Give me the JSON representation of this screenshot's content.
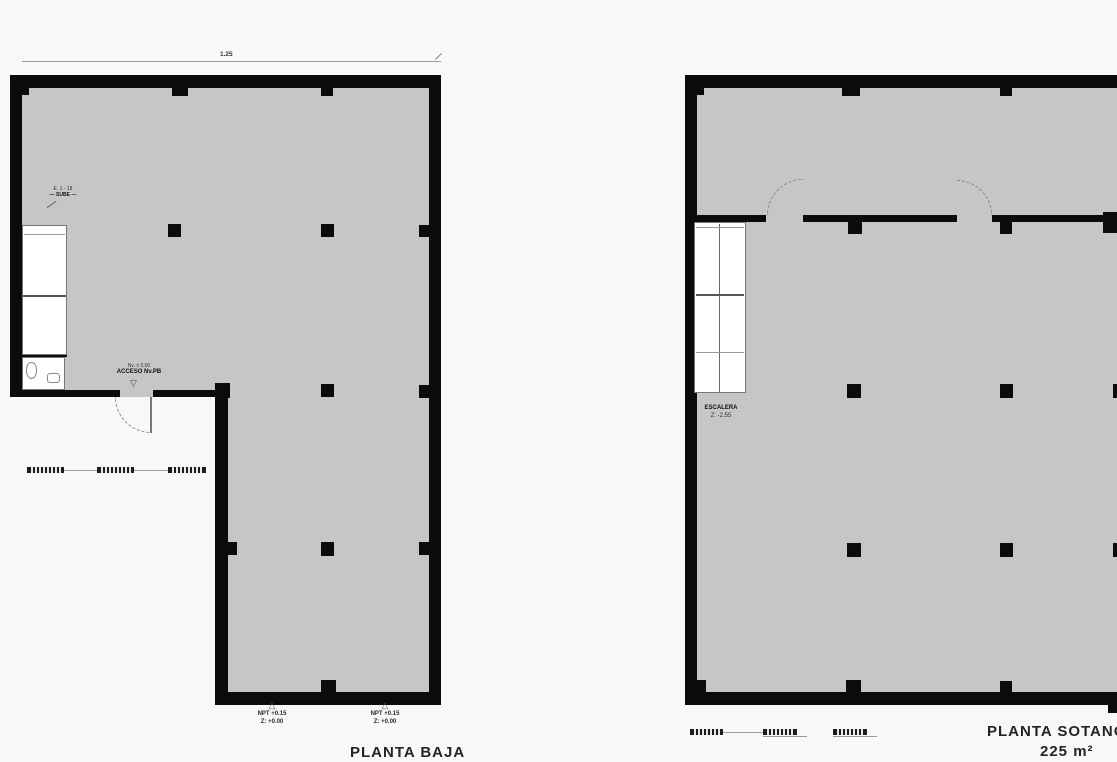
{
  "colors": {
    "plan_fill": "#c6c6c6",
    "wall": "#0b0b0b",
    "background": "#f8f8f8",
    "annotation_line": "#9a9a9a"
  },
  "left_plan": {
    "title": "PLANTA BAJA",
    "dimension_label": "1.25",
    "stair_note_line1": "E. 1 - 18",
    "stair_note_line2": "— SUBE —",
    "entrance_note_line1": "Nv. ± 0.00",
    "entrance_note_line2": "ACCESO Nv.PB",
    "entrance_marker": "▽",
    "level_marker_symbol": "△",
    "level_markers": [
      {
        "line1": "NPT +0.15",
        "line2": "Z: +0.00"
      },
      {
        "line1": "NPT +0.15",
        "line2": "Z: +0.00"
      }
    ]
  },
  "right_plan": {
    "title": "PLANTA SOTANO",
    "area_label": "225 m²",
    "stair_note_line1": "ESCALERA",
    "stair_note_line2": "Z: -2.55"
  }
}
